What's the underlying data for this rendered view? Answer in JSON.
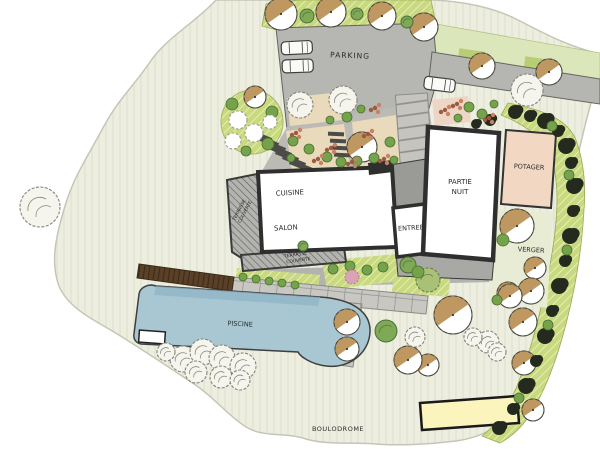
{
  "plan": {
    "type": "residential-garden-landscape-plan",
    "labels": {
      "parking": "PARKING",
      "cuisine": "CUISINE",
      "salon": "SALON",
      "entree": "ENTREE",
      "partie_nuit": [
        "PARTIE",
        "NUIT"
      ],
      "potager": "POTAGER",
      "verger": "VERGER",
      "terrasse_couverte_left": [
        "TERRASSE",
        "COUVERTE"
      ],
      "terrasse_couverte_bottom": [
        "TERRASSE",
        "COUVERTE"
      ],
      "piscine": "PISCINE",
      "boulodrome": "BOULODROME"
    },
    "colors": {
      "background": "#ffffff",
      "lawn_cream": "#edeee0",
      "hedge_strip_green": "#c8d97e",
      "pale_band_green": "#dce6bb",
      "hardscape_gray": "#b6b6b2",
      "wall_dark": "#2f2f2f",
      "room_white": "#ffffff",
      "terrace_hatch": "#b3b3af",
      "potager_pink": "#f2d8c3",
      "bed_beige": "#e9dabc",
      "pool_blue": "#a9c7d3",
      "pool_shade": "#8db3c3",
      "deck_brown": "#5a4026",
      "court_yellow": "#fbf4bd",
      "tree_crown_tan": "#b98f52",
      "tree_green": "#7fa954",
      "shrub_dark": "#242a1e",
      "flower_rust": "#9c5a40"
    },
    "symbols": {
      "deciduous-tree-icon": "circle with tan half crown and center dot",
      "green-tree-icon": "solid green circle",
      "sketch-tree-icon": "hand-drawn gray circle",
      "dark-shrub-icon": "dark green blob chain along boundary hedge",
      "bush-icon": "small green circle",
      "white-flower-icon": "scalloped white circle",
      "flower-cluster-icon": "group of rust colored dots",
      "car-icon": "top view parked car"
    }
  },
  "features": {
    "trees": [
      {
        "type": "tan",
        "x": 281,
        "y": 14,
        "r": 16
      },
      {
        "type": "tan",
        "x": 331,
        "y": 12,
        "r": 15
      },
      {
        "type": "tan",
        "x": 382,
        "y": 16,
        "r": 14
      },
      {
        "type": "tan",
        "x": 424,
        "y": 27,
        "r": 14
      },
      {
        "type": "tan",
        "x": 482,
        "y": 66,
        "r": 13
      },
      {
        "type": "tan",
        "x": 549,
        "y": 72,
        "r": 13
      },
      {
        "type": "tan",
        "x": 255,
        "y": 97,
        "r": 11
      },
      {
        "type": "tan",
        "x": 362,
        "y": 147,
        "r": 15
      },
      {
        "type": "tan",
        "x": 517,
        "y": 226,
        "r": 17
      },
      {
        "type": "tan",
        "x": 535,
        "y": 268,
        "r": 11
      },
      {
        "type": "tan",
        "x": 531,
        "y": 291,
        "r": 13
      },
      {
        "type": "tan",
        "x": 508,
        "y": 293,
        "r": 11
      },
      {
        "type": "tan",
        "x": 453,
        "y": 315,
        "r": 19
      },
      {
        "type": "tan",
        "x": 510,
        "y": 296,
        "r": 12
      },
      {
        "type": "tan",
        "x": 523,
        "y": 322,
        "r": 14
      },
      {
        "type": "tan",
        "x": 524,
        "y": 363,
        "r": 12
      },
      {
        "type": "tan",
        "x": 533,
        "y": 410,
        "r": 11
      },
      {
        "type": "tan",
        "x": 428,
        "y": 365,
        "r": 11
      },
      {
        "type": "tan",
        "x": 408,
        "y": 360,
        "r": 14
      },
      {
        "type": "tan",
        "x": 347,
        "y": 322,
        "r": 13
      },
      {
        "type": "tan",
        "x": 347,
        "y": 349,
        "r": 12
      },
      {
        "type": "green",
        "x": 307,
        "y": 16,
        "r": 7
      },
      {
        "type": "green",
        "x": 357,
        "y": 14,
        "r": 6
      },
      {
        "type": "green",
        "x": 407,
        "y": 22,
        "r": 6
      },
      {
        "type": "green",
        "x": 386,
        "y": 331,
        "r": 11
      },
      {
        "type": "green",
        "x": 303,
        "y": 246,
        "r": 5
      },
      {
        "type": "green",
        "x": 408,
        "y": 265,
        "r": 8
      },
      {
        "type": "sketchgreen",
        "x": 428,
        "y": 280,
        "r": 12
      },
      {
        "type": "sketch",
        "x": 40,
        "y": 207,
        "r": 20
      },
      {
        "type": "sketch",
        "x": 527,
        "y": 90,
        "r": 16
      },
      {
        "type": "sketch",
        "x": 300,
        "y": 105,
        "r": 13
      },
      {
        "type": "sketch",
        "x": 343,
        "y": 100,
        "r": 14
      },
      {
        "type": "sketch",
        "x": 488,
        "y": 342,
        "r": 11
      },
      {
        "type": "sketch",
        "x": 473,
        "y": 337,
        "r": 9
      },
      {
        "type": "sketch",
        "x": 497,
        "y": 352,
        "r": 9
      },
      {
        "type": "sketch",
        "x": 415,
        "y": 337,
        "r": 10
      },
      {
        "type": "sketch",
        "x": 183,
        "y": 359,
        "r": 13
      },
      {
        "type": "sketch",
        "x": 203,
        "y": 352,
        "r": 13
      },
      {
        "type": "sketch",
        "x": 222,
        "y": 358,
        "r": 13
      },
      {
        "type": "sketch",
        "x": 243,
        "y": 366,
        "r": 13
      },
      {
        "type": "sketch",
        "x": 196,
        "y": 372,
        "r": 11
      },
      {
        "type": "sketch",
        "x": 221,
        "y": 377,
        "r": 11
      },
      {
        "type": "sketch",
        "x": 240,
        "y": 380,
        "r": 10
      },
      {
        "type": "sketch",
        "x": 166,
        "y": 352,
        "r": 9
      },
      {
        "type": "dark",
        "x": 515,
        "y": 112,
        "r": 7
      },
      {
        "type": "dark",
        "x": 530,
        "y": 116,
        "r": 6
      },
      {
        "type": "dark",
        "x": 545,
        "y": 121,
        "r": 8
      },
      {
        "type": "dark",
        "x": 558,
        "y": 131,
        "r": 6
      },
      {
        "type": "dark",
        "x": 566,
        "y": 146,
        "r": 8
      },
      {
        "type": "dark",
        "x": 571,
        "y": 163,
        "r": 6
      },
      {
        "type": "dark",
        "x": 574,
        "y": 186,
        "r": 8
      },
      {
        "type": "dark",
        "x": 573,
        "y": 211,
        "r": 6
      },
      {
        "type": "dark",
        "x": 570,
        "y": 236,
        "r": 8
      },
      {
        "type": "dark",
        "x": 565,
        "y": 261,
        "r": 6
      },
      {
        "type": "dark",
        "x": 559,
        "y": 286,
        "r": 8
      },
      {
        "type": "dark",
        "x": 552,
        "y": 311,
        "r": 6
      },
      {
        "type": "dark",
        "x": 545,
        "y": 336,
        "r": 8
      },
      {
        "type": "dark",
        "x": 536,
        "y": 361,
        "r": 6
      },
      {
        "type": "dark",
        "x": 526,
        "y": 386,
        "r": 8
      },
      {
        "type": "dark",
        "x": 513,
        "y": 409,
        "r": 6
      },
      {
        "type": "dark",
        "x": 499,
        "y": 428,
        "r": 7
      },
      {
        "type": "dark",
        "x": 490,
        "y": 120,
        "r": 6
      },
      {
        "type": "dark",
        "x": 476,
        "y": 124,
        "r": 5
      },
      {
        "type": "bush",
        "x": 552,
        "y": 126,
        "r": 5
      },
      {
        "type": "bush",
        "x": 569,
        "y": 175,
        "r": 5
      },
      {
        "type": "bush",
        "x": 567,
        "y": 250,
        "r": 5
      },
      {
        "type": "bush",
        "x": 548,
        "y": 325,
        "r": 5
      },
      {
        "type": "bush",
        "x": 519,
        "y": 398,
        "r": 5
      },
      {
        "type": "bush",
        "x": 293,
        "y": 141,
        "r": 5
      },
      {
        "type": "bush",
        "x": 309,
        "y": 149,
        "r": 5
      },
      {
        "type": "bush",
        "x": 327,
        "y": 157,
        "r": 5
      },
      {
        "type": "bush",
        "x": 291,
        "y": 158,
        "r": 4
      },
      {
        "type": "bush",
        "x": 341,
        "y": 162,
        "r": 5
      },
      {
        "type": "bush",
        "x": 357,
        "y": 161,
        "r": 5
      },
      {
        "type": "bush",
        "x": 374,
        "y": 158,
        "r": 5
      },
      {
        "type": "bush",
        "x": 390,
        "y": 142,
        "r": 5
      },
      {
        "type": "bush",
        "x": 394,
        "y": 160,
        "r": 4
      },
      {
        "type": "bush",
        "x": 347,
        "y": 117,
        "r": 5
      },
      {
        "type": "bush",
        "x": 361,
        "y": 109,
        "r": 4
      },
      {
        "type": "bush",
        "x": 330,
        "y": 120,
        "r": 4
      },
      {
        "type": "bush",
        "x": 469,
        "y": 107,
        "r": 5
      },
      {
        "type": "bush",
        "x": 482,
        "y": 114,
        "r": 5
      },
      {
        "type": "bush",
        "x": 494,
        "y": 104,
        "r": 4
      },
      {
        "type": "bush",
        "x": 458,
        "y": 118,
        "r": 4
      },
      {
        "type": "bush",
        "x": 243,
        "y": 277,
        "r": 4
      },
      {
        "type": "bush",
        "x": 256,
        "y": 279,
        "r": 4
      },
      {
        "type": "bush",
        "x": 269,
        "y": 281,
        "r": 4
      },
      {
        "type": "bush",
        "x": 282,
        "y": 283,
        "r": 4
      },
      {
        "type": "bush",
        "x": 295,
        "y": 285,
        "r": 4
      },
      {
        "type": "bush",
        "x": 333,
        "y": 269,
        "r": 5
      },
      {
        "type": "bush",
        "x": 350,
        "y": 266,
        "r": 5
      },
      {
        "type": "bush",
        "x": 367,
        "y": 270,
        "r": 5
      },
      {
        "type": "bush",
        "x": 383,
        "y": 267,
        "r": 5
      },
      {
        "type": "bush",
        "x": 232,
        "y": 104,
        "r": 6
      },
      {
        "type": "bush",
        "x": 272,
        "y": 112,
        "r": 6
      },
      {
        "type": "bush",
        "x": 268,
        "y": 144,
        "r": 6
      },
      {
        "type": "bush",
        "x": 246,
        "y": 151,
        "r": 5
      },
      {
        "type": "bush",
        "x": 418,
        "y": 272,
        "r": 6
      },
      {
        "type": "bush",
        "x": 503,
        "y": 240,
        "r": 6
      },
      {
        "type": "bush",
        "x": 497,
        "y": 300,
        "r": 5
      },
      {
        "type": "whiteflower",
        "x": 238,
        "y": 120,
        "r": 9
      },
      {
        "type": "whiteflower",
        "x": 254,
        "y": 133,
        "r": 9
      },
      {
        "type": "whiteflower",
        "x": 233,
        "y": 141,
        "r": 8
      },
      {
        "type": "whiteflower",
        "x": 270,
        "y": 122,
        "r": 7
      },
      {
        "type": "pink",
        "x": 352,
        "y": 277,
        "r": 7
      }
    ],
    "flower_clusters": [
      [
        296,
        133
      ],
      [
        318,
        159
      ],
      [
        368,
        134
      ],
      [
        384,
        159
      ],
      [
        445,
        110
      ],
      [
        457,
        104
      ],
      [
        489,
        118
      ],
      [
        331,
        148
      ],
      [
        375,
        108
      ],
      [
        352,
        162
      ]
    ]
  }
}
